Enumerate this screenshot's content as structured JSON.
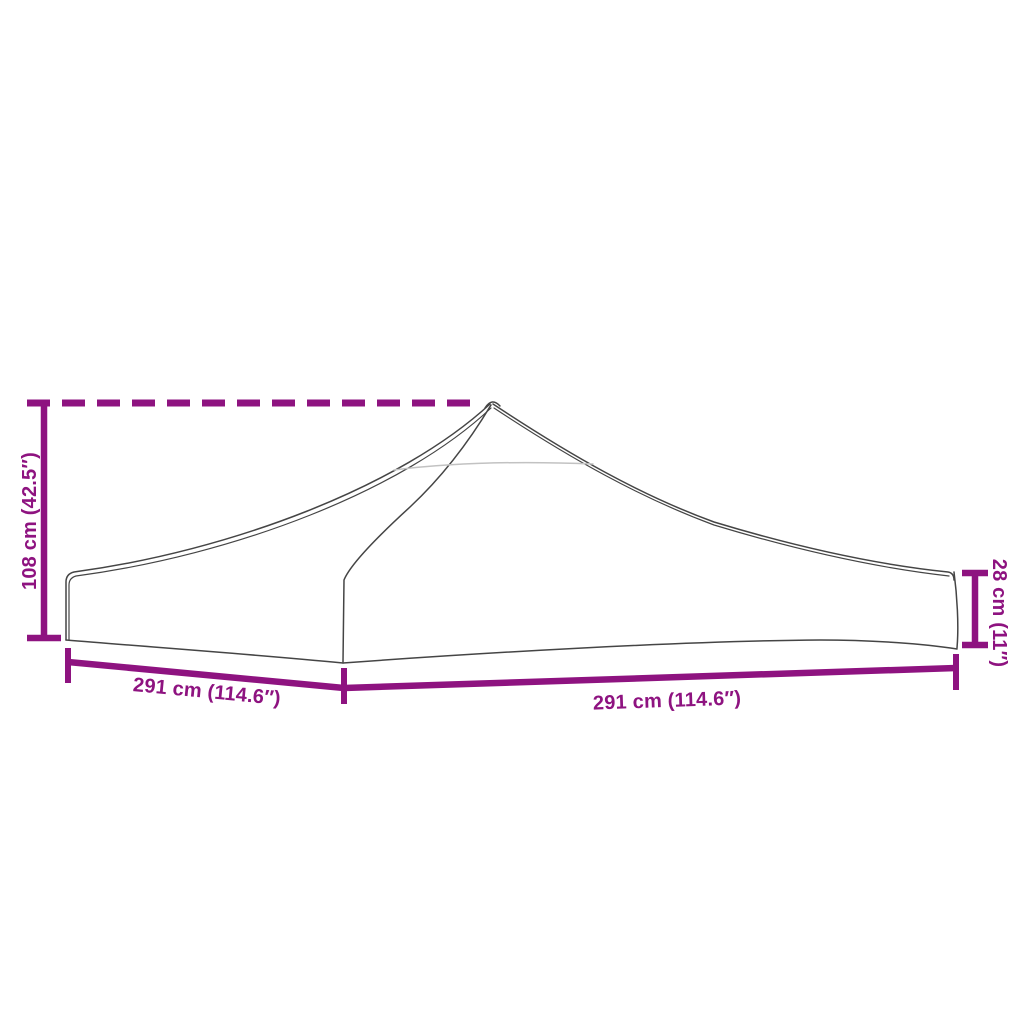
{
  "diagram": {
    "colors": {
      "accent": "#8E1380",
      "outline": "#454545",
      "faint": "#C2C2C2",
      "background": "#FFFFFF"
    },
    "labels": {
      "total_height": "108 cm (42.5″)",
      "edge_height": "28 cm (11″)",
      "width_left": "291 cm (114.6″)",
      "width_right": "291 cm (114.6″)"
    }
  }
}
